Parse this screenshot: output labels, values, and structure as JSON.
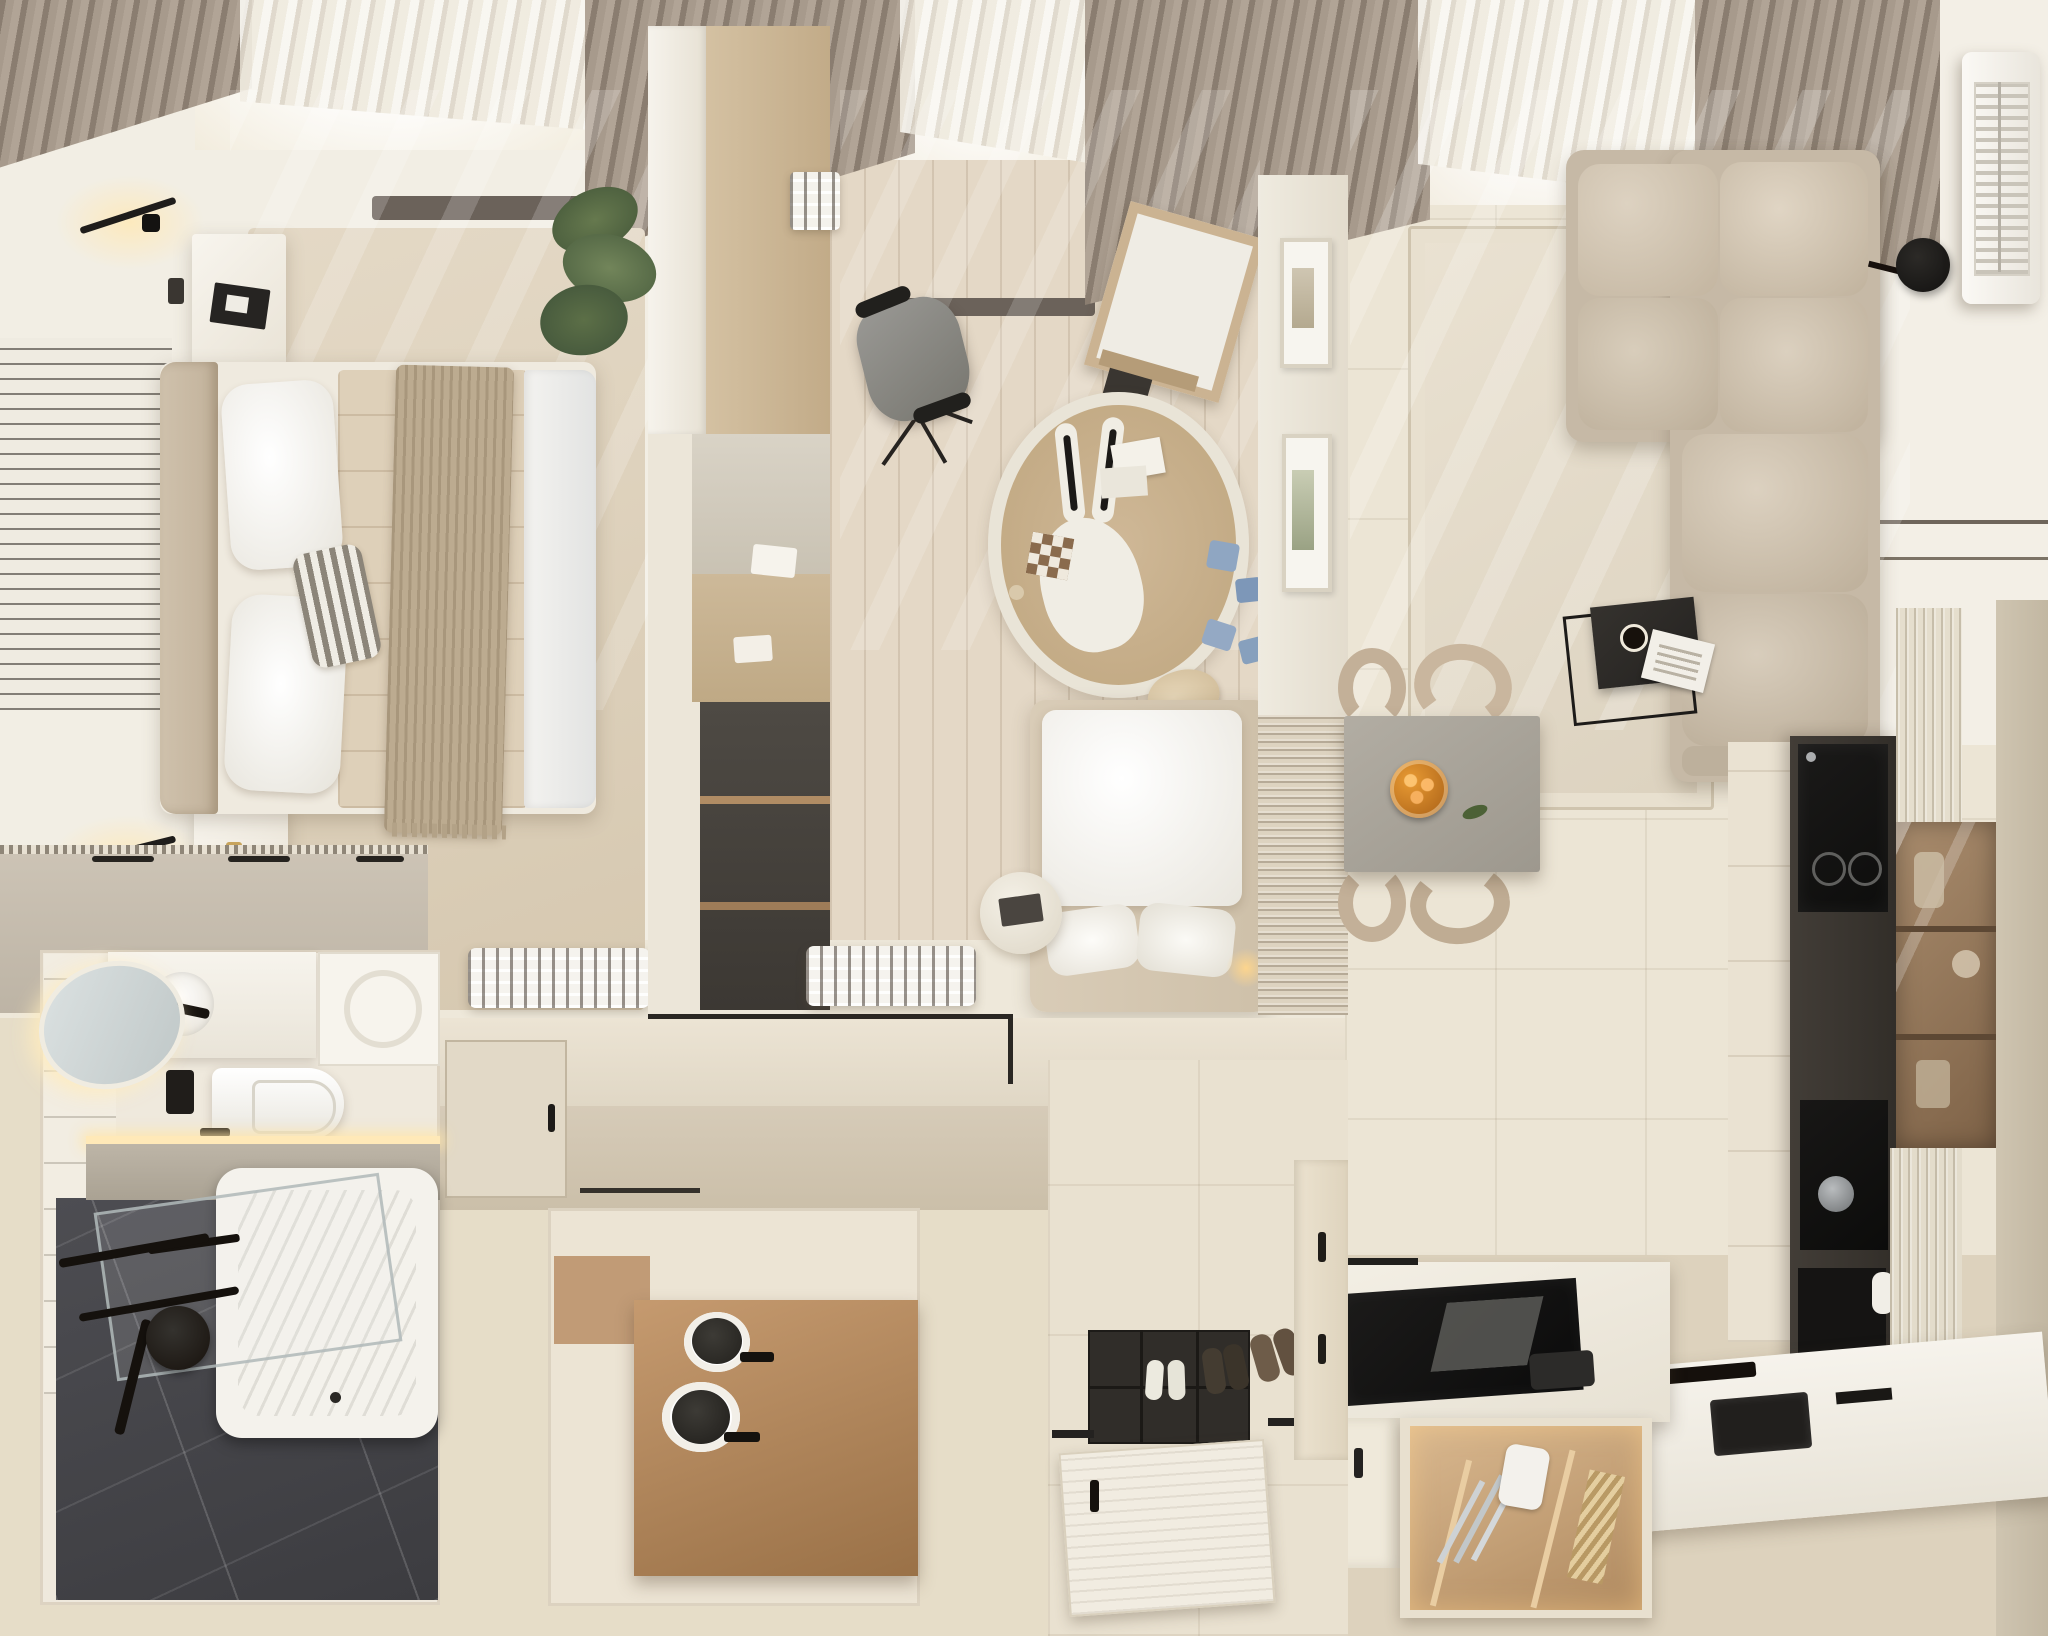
{
  "meta": {
    "type": "photorealistic 3d render",
    "view": "top-down apartment floor plan",
    "text_content": "none"
  },
  "palette": {
    "outer": "#e6ddc8",
    "wall": "#f2eee4",
    "wall_dim": "#e9e1d1",
    "floor_tile": "#ece5d5",
    "wood": "#d2bfa3",
    "wood_pale": "#e4d8c6",
    "walnut": "#ad8661",
    "oak": "#c9b394",
    "curtain": "#a89a8d",
    "sheer": "#f6f3ec",
    "rug_bed": "#ddd1bc",
    "rug_kids": "#c9b192",
    "rug_living": "#e4dbca",
    "sofa": "#cfc3b1",
    "stone": "#a8a39a",
    "chair": "#c3b098",
    "black": "#1f1d1b",
    "dark_unit": "#38342f",
    "bronze": "#9b7f63",
    "greige": "#d8cdba",
    "dresser": "#c8bfb1",
    "marble": "#46464b",
    "tub": "#f4f2ec",
    "led": "#ffe9b8",
    "accent_orange": "#d98a2b",
    "toy_blue": "#8fa6c2",
    "plant_green": "#5c6b45"
  },
  "scene": {
    "rooms": [
      {
        "name": "bedroom",
        "objects": [
          "double-bed",
          "headboard",
          "pillows",
          "striped-pillow",
          "quilted-duvet",
          "knit-throw",
          "nightstand-top",
          "nightstand-bottom",
          "wall-sconce-1",
          "wall-sconce-2",
          "slat-wall-panel",
          "area-rug",
          "dresser",
          "air-vent",
          "curtains",
          "window-light"
        ]
      },
      {
        "name": "kids-room",
        "objects": [
          "desk-unit",
          "office-chair",
          "easel",
          "round-bunny-rug",
          "toy-blocks",
          "plush-toy",
          "kids-bed",
          "round-side-table",
          "air-vent",
          "picture-frames",
          "ribbed-wall-panel",
          "curtains"
        ]
      },
      {
        "name": "living-room",
        "objects": [
          "sectional-sofa",
          "coffee-side-table",
          "magazine",
          "coffee-cup",
          "area-rug",
          "wall-sconce-disc",
          "ac-unit",
          "curtains",
          "window-light"
        ]
      },
      {
        "name": "dining-area",
        "objects": [
          "stone-dining-table",
          "fruit-bowl",
          "dining-chairs-x4"
        ]
      },
      {
        "name": "kitchen",
        "objects": [
          "tall-dark-appliance-column",
          "built-in-oven",
          "coffee-machine",
          "fluted-panels",
          "bronze-glass-cabinet",
          "island-with-induction-hob",
          "open-cutlery-drawer",
          "knives",
          "counter-with-sink"
        ]
      },
      {
        "name": "bathroom",
        "objects": [
          "oval-backlit-mirror",
          "vanity-counter",
          "black-faucet",
          "wall-hung-toilet",
          "flush-plate",
          "stone-ledge",
          "led-strip",
          "bathtub",
          "glass-screen",
          "shower-head",
          "towel-bars",
          "marble-floor"
        ]
      },
      {
        "name": "hallway",
        "objects": [
          "closet-door",
          "wall-trim"
        ]
      },
      {
        "name": "utility-room",
        "objects": [
          "walnut-counter",
          "round-basins",
          "wood-niche"
        ]
      },
      {
        "name": "entry",
        "objects": [
          "doormat",
          "slippers",
          "shoes",
          "open-front-door",
          "shoe-cabinet"
        ]
      }
    ]
  }
}
